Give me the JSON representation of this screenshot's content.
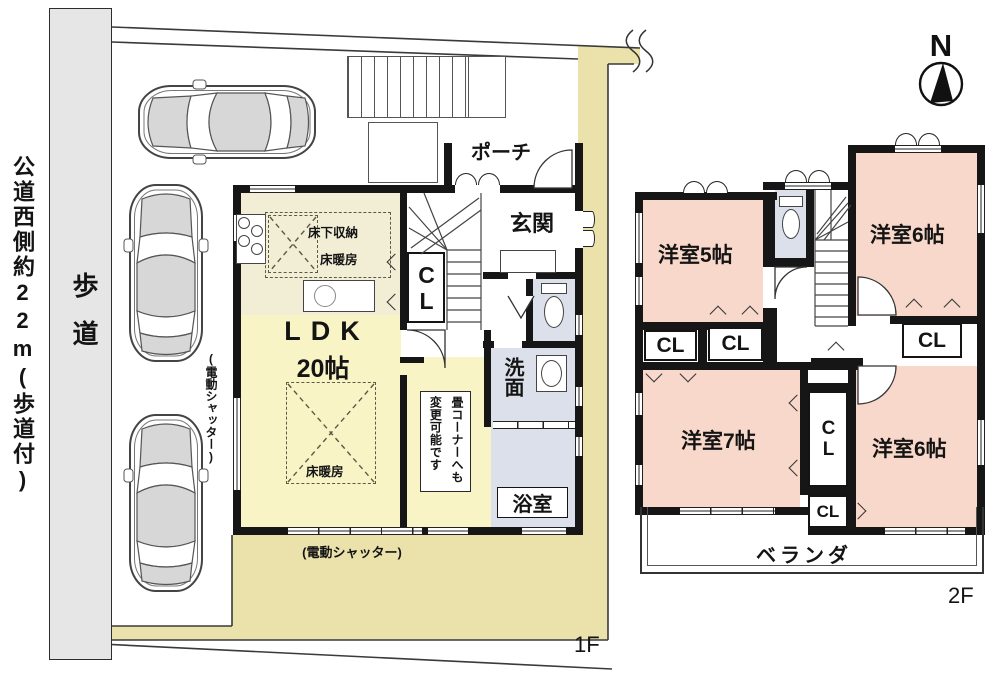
{
  "colors": {
    "wall": "#161616",
    "ldk_yellow": "#f8f4c6",
    "kitchen_pale": "#f2eed6",
    "outdoor_beige": "#ebe2ab",
    "bedroom_pink": "#f8d8ca",
    "wet_blue": "#dbe0ea",
    "sidewalk_gray": "#e6e6e6"
  },
  "site": {
    "road_label": "公道西側約22m(歩道付)",
    "sidewalk_label": "歩道",
    "compass_north": "N",
    "floor1_tag": "1F",
    "floor2_tag": "2F"
  },
  "floor1": {
    "porch": "ポーチ",
    "entrance": "玄関",
    "ldk_name": "LDK",
    "ldk_size": "20帖",
    "underfloor_storage": "床下収納",
    "floor_heating_kitchen": "床暖房",
    "floor_heating_living": "床暖房",
    "closet": "CL",
    "washroom": "洗面",
    "bathroom": "浴室",
    "tatami_note": "畳コーナーへも変更可能です",
    "shutter_side": "(電動シャッター)",
    "shutter_bottom": "(電動シャッター)"
  },
  "floor2": {
    "bedroom_5": "洋室5帖",
    "bedroom_6_top": "洋室6帖",
    "bedroom_7": "洋室7帖",
    "bedroom_6_bottom": "洋室6帖",
    "closet_1": "CL",
    "closet_2": "CL",
    "closet_3": "CL",
    "closet_mid": "CL",
    "closet_low": "CL",
    "veranda": "ベランダ"
  }
}
